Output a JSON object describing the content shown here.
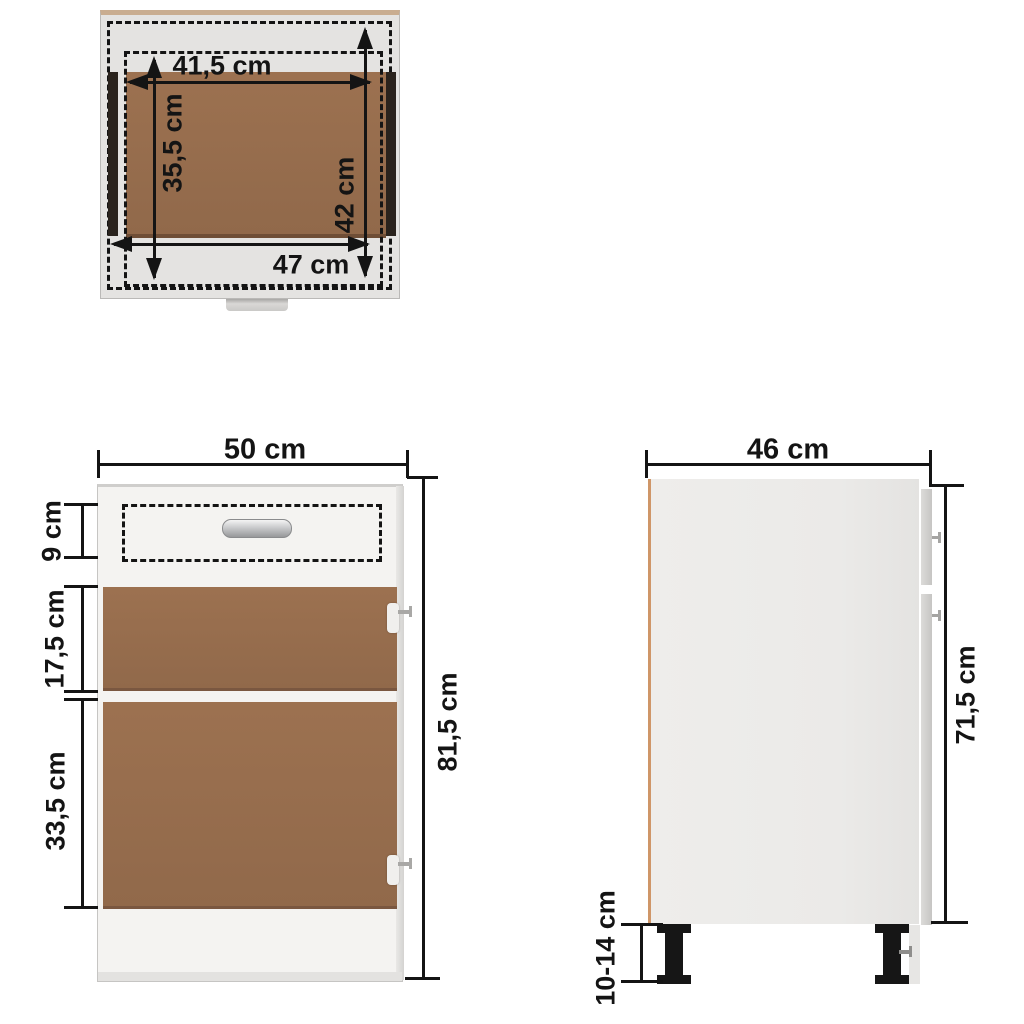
{
  "diagram_title": "Kitchen base cabinet with drawer - dimension drawing",
  "views": {
    "top_view": {
      "dim_width_inner": "41,5 cm",
      "dim_depth_inner": "35,5 cm",
      "dim_depth_outer": "42 cm",
      "dim_width_outer": "47 cm"
    },
    "front_view": {
      "dim_width": "50 cm",
      "dim_drawer_height": "9 cm",
      "dim_upper_door_height": "17,5 cm",
      "dim_lower_door_height": "33,5 cm",
      "dim_total_height": "81,5 cm"
    },
    "side_view": {
      "dim_depth": "46 cm",
      "dim_body_height": "71,5 cm",
      "dim_leg_height": "10-14 cm"
    }
  },
  "colors": {
    "panel_brown": "#9c7150",
    "panel_brown_edge": "#6f4e36",
    "cabinet_gray_top": "#e4e3e1",
    "cabinet_gray_front": "#f4f3f1",
    "cabinet_gray_side": "#edecea",
    "edge_tan": "#cf9668",
    "drawer_slide_dark": "#2a231d",
    "dimension_black": "#141414",
    "leg_black": "#161616",
    "background": "#ffffff"
  }
}
